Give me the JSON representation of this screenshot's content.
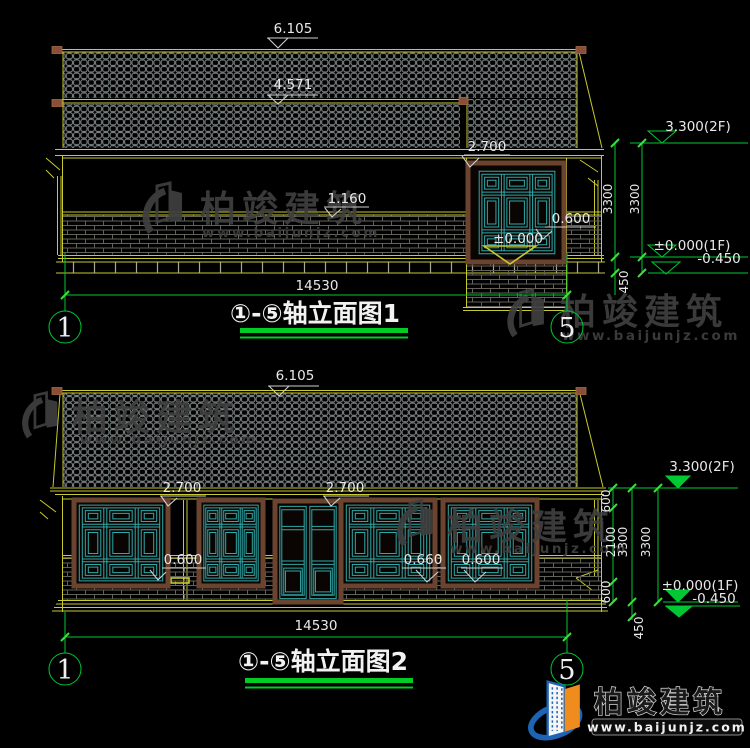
{
  "watermark": {
    "brand": "柏竣建筑",
    "url": "www.baijunjz.com"
  },
  "brand_logo": {
    "brand": "柏竣建筑",
    "url": "www.baijunjz.com"
  },
  "colors": {
    "cad_yellow": "#c9c930",
    "cad_green": "#00c832",
    "cad_teal": "#2fa8a8",
    "dim_white": "#e9e9e9",
    "watermark_gray": "#3f3f3f",
    "logo_blue": "#1e64b4",
    "logo_orange": "#f08c1e"
  },
  "drawing1": {
    "title": "①-⑤轴立面图1",
    "axis_left": "1",
    "axis_right": "5",
    "dim_ridge": "6.105",
    "dim_lower_ridge": "4.571",
    "dim_window_head": "2.700",
    "dim_band": "1.160",
    "dim_sill": "0.600",
    "dim_floor": "±0.000",
    "dim_total": "14530",
    "lvl_2f": "3.300(2F)",
    "lvl_1f": "±0.000(1F)",
    "lvl_ground": "-0.450",
    "dim_story_a": "3300",
    "dim_story_b": "3300",
    "dim_plinth": "450"
  },
  "drawing2": {
    "title": "①-⑤轴立面图2",
    "axis_left": "1",
    "axis_right": "5",
    "dim_ridge": "6.105",
    "dim_head_left": "2.700",
    "dim_head_right": "2.700",
    "dim_sill_left": "0.600",
    "dim_sill_mid": "0.660",
    "dim_sill_right": "0.600",
    "dim_total": "14530",
    "lvl_2f": "3.300(2F)",
    "lvl_1f": "±0.000(1F)",
    "lvl_ground": "-0.450",
    "dim_head": "600",
    "dim_window_h": "2100",
    "dim_story_a": "3300",
    "dim_story_b": "3300",
    "dim_sill_h": "600",
    "dim_plinth": "450"
  }
}
